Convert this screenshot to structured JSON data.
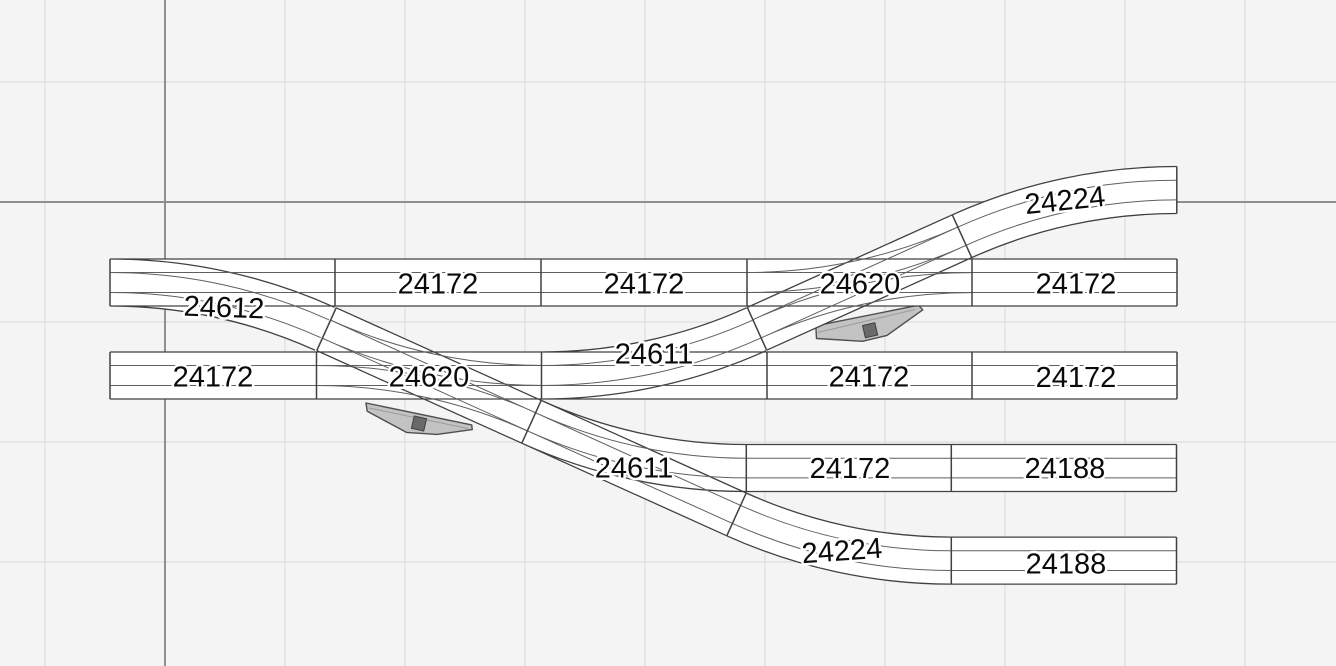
{
  "canvas": {
    "background": "#f4f4f4",
    "grid_minor": "#dedede",
    "grid_major": "#8f8f8f"
  },
  "track": {
    "track_fill": "#ffffff",
    "outline": "#414141",
    "rail": "#5f5f5f",
    "label_color": "#0a0a0a",
    "motor_fill": "#c3c3c3",
    "motor_outline": "#4f4f4f",
    "motor_actuator": "#6a6a6a"
  },
  "labels": [
    {
      "id": "curve-top-right",
      "text": "24224"
    },
    {
      "id": "row1-straight-b",
      "text": "24172"
    },
    {
      "id": "row1-straight-c",
      "text": "24172"
    },
    {
      "id": "crossing-upper",
      "text": "24620"
    },
    {
      "id": "row1-straight-d",
      "text": "24172"
    },
    {
      "id": "turnout-top-left",
      "text": "24612"
    },
    {
      "id": "turnout-diagonal-upper",
      "text": "24611"
    },
    {
      "id": "row2-straight-a",
      "text": "24172"
    },
    {
      "id": "crossing-lower",
      "text": "24620"
    },
    {
      "id": "row2-straight-b",
      "text": "24172"
    },
    {
      "id": "row2-straight-c",
      "text": "24172"
    },
    {
      "id": "turnout-diagonal-lower",
      "text": "24611"
    },
    {
      "id": "row3-straight",
      "text": "24172"
    },
    {
      "id": "row3-straight-end",
      "text": "24188"
    },
    {
      "id": "curve-bottom",
      "text": "24224"
    },
    {
      "id": "row4-straight-end",
      "text": "24188"
    }
  ]
}
